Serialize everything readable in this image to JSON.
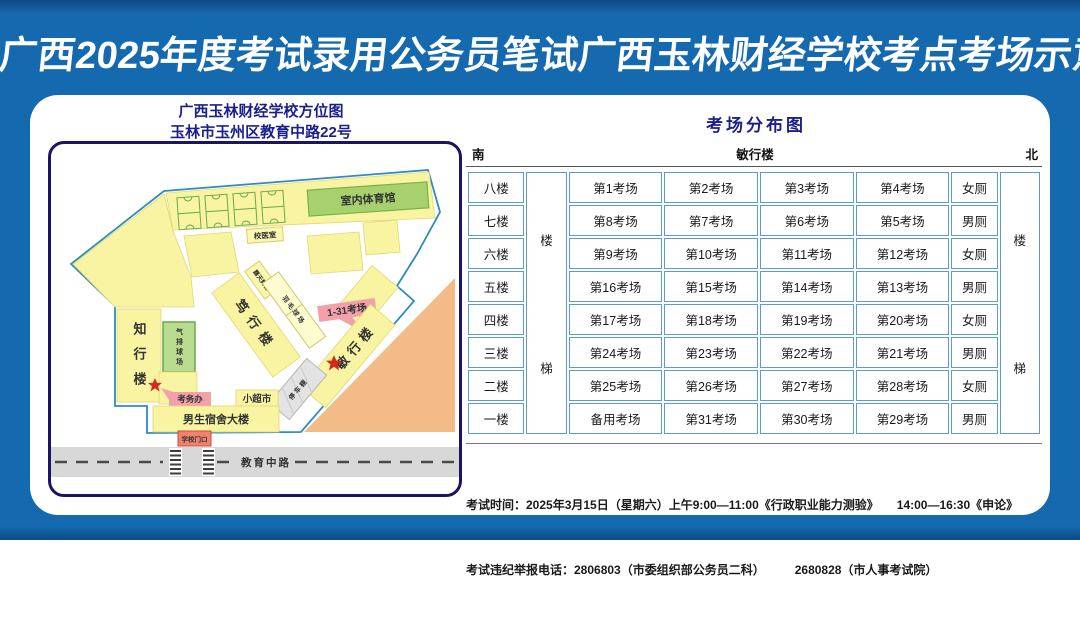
{
  "page": {
    "title": "广西2025年度考试录用公务员笔试广西玉林财经学校考点考场示意图"
  },
  "colors": {
    "background_blue": "#1569ae",
    "panel_white": "#ffffff",
    "frame_navy": "#1b1464",
    "heading_navy": "#1b1f8c",
    "table_border_blue": "#5b9bd5",
    "building_yellow": "#f8f4a2",
    "court_green": "#a6d16d",
    "callout_pink": "#f2a0aa",
    "callout_red": "#cc2222",
    "gate_red": "#f08272",
    "sand_orange": "#f2bb87",
    "road_gray": "#d8d8d8"
  },
  "map": {
    "title_line1": "广西玉林财经学校方位图",
    "title_line2": "玉林市玉州区教育中路22号",
    "labels": {
      "gym": "室内体育馆",
      "clinic": "校医室",
      "duxing": "笃行楼",
      "stage": "露天舞台",
      "court_thin": "羽毛球场",
      "callout_rooms": "1-31考场",
      "minxing": "敏行楼",
      "parking": "停车棚",
      "zhixing": "知行楼",
      "volleyball": "气排球场",
      "exam_office": "考务办",
      "supermarket": "小超市",
      "dorm": "男生宿舍大楼",
      "gate": "学校门口",
      "road": "教育中路"
    }
  },
  "distribution": {
    "title": "考场分布图",
    "south": "南",
    "building": "敏行楼",
    "north": "北",
    "stairs_upper": "楼",
    "stairs_lower": "梯",
    "floors": [
      {
        "floor": "八楼",
        "rooms": [
          "第1考场",
          "第2考场",
          "第3考场",
          "第4考场"
        ],
        "toilet": "女厕"
      },
      {
        "floor": "七楼",
        "rooms": [
          "第8考场",
          "第7考场",
          "第6考场",
          "第5考场"
        ],
        "toilet": "男厕"
      },
      {
        "floor": "六楼",
        "rooms": [
          "第9考场",
          "第10考场",
          "第11考场",
          "第12考场"
        ],
        "toilet": "女厕"
      },
      {
        "floor": "五楼",
        "rooms": [
          "第16考场",
          "第15考场",
          "第14考场",
          "第13考场"
        ],
        "toilet": "男厕"
      },
      {
        "floor": "四楼",
        "rooms": [
          "第17考场",
          "第18考场",
          "第19考场",
          "第20考场"
        ],
        "toilet": "女厕"
      },
      {
        "floor": "三楼",
        "rooms": [
          "第24考场",
          "第23考场",
          "第22考场",
          "第21考场"
        ],
        "toilet": "男厕"
      },
      {
        "floor": "二楼",
        "rooms": [
          "第25考场",
          "第26考场",
          "第27考场",
          "第28考场"
        ],
        "toilet": "女厕"
      },
      {
        "floor": "一楼",
        "rooms": [
          "备用考场",
          "第31考场",
          "第30考场",
          "第29考场"
        ],
        "toilet": "男厕"
      }
    ]
  },
  "footer": {
    "line1": "考试时间：2025年3月15日（星期六）上午9:00—11:00《行政职业能力测验》　　14:00—16:30《申论》",
    "line2": "考试违纪举报电话：2806803（市委组织部公务员二科）　　　2680828（市人事考试院）"
  }
}
